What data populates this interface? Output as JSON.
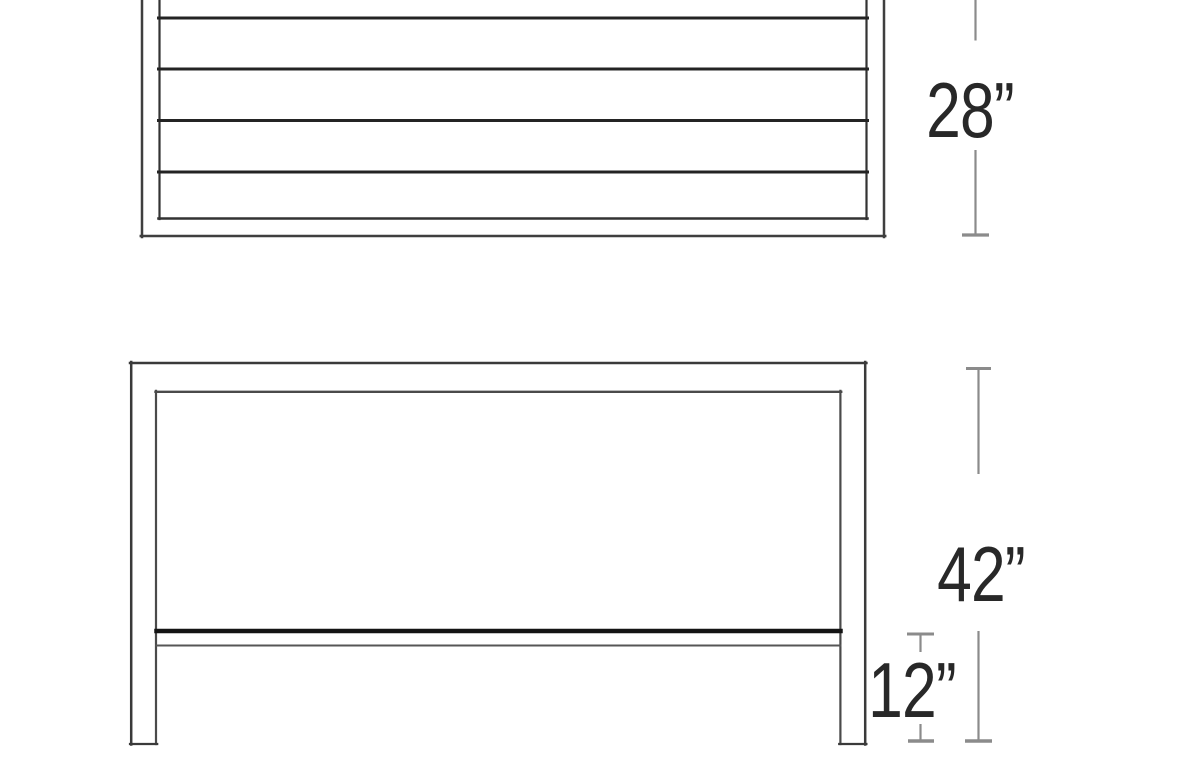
{
  "page": {
    "title": "Furniture dimension diagram",
    "background": "#ffffff"
  },
  "diagram": {
    "kind": "technical line drawing",
    "views": [
      {
        "id": "plan",
        "name": "Slatted table top - plan view (cropped at top)",
        "slat_lines": 4
      },
      {
        "id": "elevation",
        "name": "Table front elevation with lower shelf"
      }
    ],
    "dimensions": [
      {
        "id": "depth",
        "label": "28”",
        "value": 28,
        "unit": "inches",
        "applies_to": "plan"
      },
      {
        "id": "height",
        "label": "42”",
        "value": 42,
        "unit": "inches",
        "applies_to": "elevation"
      },
      {
        "id": "shelf_height",
        "label": "12”",
        "value": 12,
        "unit": "inches",
        "applies_to": "elevation"
      }
    ],
    "colors": {
      "outline": "#3f3f3f",
      "inner_outline": "#4a4a4a",
      "slat_line": "#242424",
      "shelf_top_line": "#141414",
      "shelf_bottom_line": "#565656",
      "dimension_line": "#8b8b8b",
      "label_text": "#282828",
      "background": "#ffffff"
    }
  }
}
